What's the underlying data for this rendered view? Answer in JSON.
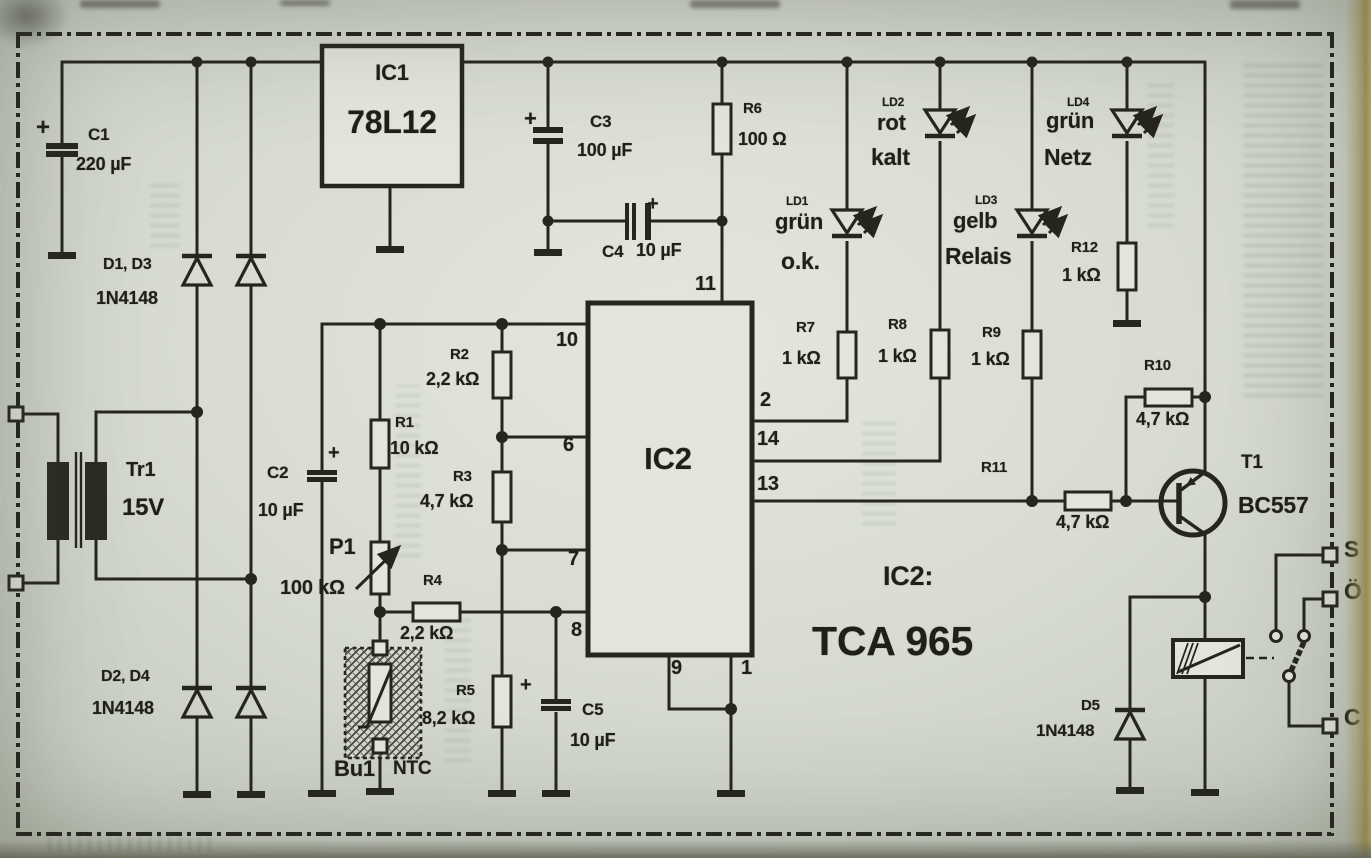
{
  "colors": {
    "paper": "#d8dbd2",
    "ink": "#26261e",
    "page_edge": "#bfae72"
  },
  "schematic": {
    "ic_note": {
      "label": "IC2:",
      "value": "TCA 965"
    },
    "components": [
      {
        "ref": "C1",
        "value": "220 µF"
      },
      {
        "ref": "C2",
        "value": "10 µF"
      },
      {
        "ref": "C3",
        "value": "100 µF"
      },
      {
        "ref": "C4",
        "value": "10 µF"
      },
      {
        "ref": "C5",
        "value": "10 µF"
      },
      {
        "ref": "R1",
        "value": "10 kΩ"
      },
      {
        "ref": "R2",
        "value": "2,2 kΩ"
      },
      {
        "ref": "R3",
        "value": "4,7 kΩ"
      },
      {
        "ref": "R4",
        "value": "2,2 kΩ"
      },
      {
        "ref": "R5",
        "value": "8,2 kΩ"
      },
      {
        "ref": "R6",
        "value": "100 Ω"
      },
      {
        "ref": "R7",
        "value": "1 kΩ"
      },
      {
        "ref": "R8",
        "value": "1 kΩ"
      },
      {
        "ref": "R9",
        "value": "1 kΩ"
      },
      {
        "ref": "R10",
        "value": "4,7 kΩ"
      },
      {
        "ref": "R11",
        "value": "4,7 kΩ"
      },
      {
        "ref": "R12",
        "value": "1 kΩ"
      },
      {
        "ref": "P1",
        "value": "100 kΩ"
      },
      {
        "ref": "D1, D3",
        "value": "1N4148"
      },
      {
        "ref": "D2, D4",
        "value": "1N4148"
      },
      {
        "ref": "D5",
        "value": "1N4148"
      },
      {
        "ref": "IC1",
        "value": "78L12"
      },
      {
        "ref": "IC2",
        "value": "TCA 965"
      },
      {
        "ref": "T1",
        "value": "BC557"
      },
      {
        "ref": "Tr1",
        "value": "15V"
      },
      {
        "ref": "Bu1",
        "value": "NTC"
      }
    ],
    "leds": [
      {
        "ref": "LD1",
        "color": "grün",
        "meaning": "o.k."
      },
      {
        "ref": "LD2",
        "color": "rot",
        "meaning": "kalt"
      },
      {
        "ref": "LD3",
        "color": "gelb",
        "meaning": "Relais"
      },
      {
        "ref": "LD4",
        "color": "grün",
        "meaning": "Netz"
      }
    ],
    "ic2_pin_numbers": [
      "11",
      "10",
      "6",
      "7",
      "8",
      "2",
      "14",
      "13",
      "9",
      "1"
    ],
    "relay_contact_labels": [
      "S",
      "Ö",
      "C"
    ]
  },
  "labels": [
    {
      "name": "c1-plus",
      "text": "+",
      "x": 36,
      "y": 116,
      "size": 24
    },
    {
      "name": "c1-ref",
      "text": "C1",
      "x": 88,
      "y": 126,
      "size": 17
    },
    {
      "name": "c1-value",
      "text": "220 µF",
      "x": 76,
      "y": 155,
      "size": 18
    },
    {
      "name": "d1d3-ref",
      "text": "D1, D3",
      "x": 103,
      "y": 257,
      "size": 16
    },
    {
      "name": "d1d3-value",
      "text": "1N4148",
      "x": 96,
      "y": 289,
      "size": 18
    },
    {
      "name": "ic1-ref",
      "text": "IC1",
      "x": 392,
      "y": 62,
      "size": 22,
      "center": true
    },
    {
      "name": "ic1-value",
      "text": "78L12",
      "x": 392,
      "y": 106,
      "size": 32,
      "center": true
    },
    {
      "name": "c3-plus",
      "text": "+",
      "x": 524,
      "y": 108,
      "size": 22
    },
    {
      "name": "c3-ref",
      "text": "C3",
      "x": 590,
      "y": 113,
      "size": 17
    },
    {
      "name": "c3-value",
      "text": "100 µF",
      "x": 577,
      "y": 141,
      "size": 18
    },
    {
      "name": "c4-plus",
      "text": "+",
      "x": 647,
      "y": 194,
      "size": 20
    },
    {
      "name": "c4-ref",
      "text": "C4",
      "x": 602,
      "y": 243,
      "size": 17
    },
    {
      "name": "c4-value",
      "text": "10 µF",
      "x": 636,
      "y": 241,
      "size": 18
    },
    {
      "name": "r6-ref",
      "text": "R6",
      "x": 743,
      "y": 101,
      "size": 15
    },
    {
      "name": "r6-value",
      "text": "100 Ω",
      "x": 738,
      "y": 130,
      "size": 18
    },
    {
      "name": "pin-11",
      "text": "11",
      "x": 695,
      "y": 274,
      "size": 20
    },
    {
      "name": "ld1-ref",
      "text": "LD1",
      "x": 786,
      "y": 195,
      "size": 12
    },
    {
      "name": "ld1-color",
      "text": "grün",
      "x": 775,
      "y": 211,
      "size": 22
    },
    {
      "name": "ld1-function",
      "text": "o.k.",
      "x": 781,
      "y": 250,
      "size": 23
    },
    {
      "name": "ld2-ref",
      "text": "LD2",
      "x": 882,
      "y": 96,
      "size": 12
    },
    {
      "name": "ld2-color",
      "text": "rot",
      "x": 877,
      "y": 112,
      "size": 22
    },
    {
      "name": "ld2-function",
      "text": "kalt",
      "x": 871,
      "y": 146,
      "size": 23
    },
    {
      "name": "ld3-ref",
      "text": "LD3",
      "x": 975,
      "y": 194,
      "size": 12
    },
    {
      "name": "ld3-color",
      "text": "gelb",
      "x": 953,
      "y": 210,
      "size": 22
    },
    {
      "name": "ld3-function",
      "text": "Relais",
      "x": 945,
      "y": 245,
      "size": 23
    },
    {
      "name": "ld4-ref",
      "text": "LD4",
      "x": 1067,
      "y": 96,
      "size": 12
    },
    {
      "name": "ld4-color",
      "text": "grün",
      "x": 1046,
      "y": 110,
      "size": 22
    },
    {
      "name": "ld4-function",
      "text": "Netz",
      "x": 1044,
      "y": 146,
      "size": 23
    },
    {
      "name": "r12-ref",
      "text": "R12",
      "x": 1071,
      "y": 240,
      "size": 15
    },
    {
      "name": "r12-value",
      "text": "1 kΩ",
      "x": 1062,
      "y": 266,
      "size": 18
    },
    {
      "name": "r7-ref",
      "text": "R7",
      "x": 796,
      "y": 320,
      "size": 15
    },
    {
      "name": "r7-value",
      "text": "1 kΩ",
      "x": 782,
      "y": 349,
      "size": 18
    },
    {
      "name": "r8-ref",
      "text": "R8",
      "x": 888,
      "y": 317,
      "size": 15
    },
    {
      "name": "r8-value",
      "text": "1 kΩ",
      "x": 878,
      "y": 347,
      "size": 18
    },
    {
      "name": "r9-ref",
      "text": "R9",
      "x": 982,
      "y": 325,
      "size": 15
    },
    {
      "name": "r9-value",
      "text": "1 kΩ",
      "x": 971,
      "y": 350,
      "size": 18
    },
    {
      "name": "r10-ref",
      "text": "R10",
      "x": 1144,
      "y": 358,
      "size": 15
    },
    {
      "name": "r10-value",
      "text": "4,7 kΩ",
      "x": 1136,
      "y": 410,
      "size": 18
    },
    {
      "name": "r11-ref",
      "text": "R11",
      "x": 981,
      "y": 460,
      "size": 15
    },
    {
      "name": "r11-value",
      "text": "4,7 kΩ",
      "x": 1056,
      "y": 513,
      "size": 18
    },
    {
      "name": "t1-ref",
      "text": "T1",
      "x": 1241,
      "y": 453,
      "size": 19
    },
    {
      "name": "t1-value",
      "text": "BC557",
      "x": 1238,
      "y": 494,
      "size": 23
    },
    {
      "name": "pin-2",
      "text": "2",
      "x": 760,
      "y": 390,
      "size": 20
    },
    {
      "name": "pin-14",
      "text": "14",
      "x": 757,
      "y": 429,
      "size": 20
    },
    {
      "name": "pin-13",
      "text": "13",
      "x": 757,
      "y": 474,
      "size": 20
    },
    {
      "name": "pin-10",
      "text": "10",
      "x": 556,
      "y": 330,
      "size": 20
    },
    {
      "name": "pin-6",
      "text": "6",
      "x": 563,
      "y": 435,
      "size": 20
    },
    {
      "name": "pin-7",
      "text": "7",
      "x": 568,
      "y": 549,
      "size": 20
    },
    {
      "name": "pin-8",
      "text": "8",
      "x": 571,
      "y": 620,
      "size": 20
    },
    {
      "name": "pin-9",
      "text": "9",
      "x": 671,
      "y": 658,
      "size": 20
    },
    {
      "name": "pin-1",
      "text": "1",
      "x": 741,
      "y": 658,
      "size": 20
    },
    {
      "name": "ic2-ref",
      "text": "IC2",
      "x": 668,
      "y": 443,
      "size": 31,
      "center": true
    },
    {
      "name": "ic2-note-label",
      "text": "IC2:",
      "x": 883,
      "y": 563,
      "size": 27
    },
    {
      "name": "ic2-note-value",
      "text": "TCA 965",
      "x": 812,
      "y": 621,
      "size": 41
    },
    {
      "name": "tr1-ref",
      "text": "Tr1",
      "x": 126,
      "y": 460,
      "size": 20
    },
    {
      "name": "tr1-value",
      "text": "15V",
      "x": 122,
      "y": 496,
      "size": 24
    },
    {
      "name": "c2-ref",
      "text": "C2",
      "x": 267,
      "y": 464,
      "size": 17
    },
    {
      "name": "c2-value",
      "text": "10 µF",
      "x": 258,
      "y": 501,
      "size": 18
    },
    {
      "name": "c2-plus",
      "text": "+",
      "x": 328,
      "y": 443,
      "size": 20
    },
    {
      "name": "r1-ref",
      "text": "R1",
      "x": 395,
      "y": 415,
      "size": 15
    },
    {
      "name": "r1-value",
      "text": "10 kΩ",
      "x": 390,
      "y": 439,
      "size": 18
    },
    {
      "name": "r2-ref",
      "text": "R2",
      "x": 450,
      "y": 347,
      "size": 15
    },
    {
      "name": "r2-value",
      "text": "2,2 kΩ",
      "x": 426,
      "y": 370,
      "size": 18
    },
    {
      "name": "r3-ref",
      "text": "R3",
      "x": 453,
      "y": 469,
      "size": 15
    },
    {
      "name": "r3-value",
      "text": "4,7 kΩ",
      "x": 420,
      "y": 492,
      "size": 18
    },
    {
      "name": "p1-ref",
      "text": "P1",
      "x": 329,
      "y": 536,
      "size": 22
    },
    {
      "name": "p1-value",
      "text": "100 kΩ",
      "x": 280,
      "y": 578,
      "size": 20
    },
    {
      "name": "r4-ref",
      "text": "R4",
      "x": 423,
      "y": 573,
      "size": 15
    },
    {
      "name": "r4-value",
      "text": "2,2 kΩ",
      "x": 400,
      "y": 624,
      "size": 18
    },
    {
      "name": "d2d4-ref",
      "text": "D2, D4",
      "x": 101,
      "y": 669,
      "size": 16
    },
    {
      "name": "d2d4-value",
      "text": "1N4148",
      "x": 92,
      "y": 699,
      "size": 18
    },
    {
      "name": "bu1-ref",
      "text": "Bu1",
      "x": 334,
      "y": 758,
      "size": 22
    },
    {
      "name": "bu1-type",
      "text": "NTC",
      "x": 393,
      "y": 759,
      "size": 19
    },
    {
      "name": "r5-ref",
      "text": "R5",
      "x": 456,
      "y": 683,
      "size": 15
    },
    {
      "name": "r5-value",
      "text": "8,2 kΩ",
      "x": 422,
      "y": 709,
      "size": 18
    },
    {
      "name": "c5-plus",
      "text": "+",
      "x": 520,
      "y": 675,
      "size": 20
    },
    {
      "name": "c5-ref",
      "text": "C5",
      "x": 582,
      "y": 701,
      "size": 17
    },
    {
      "name": "c5-value",
      "text": "10 µF",
      "x": 570,
      "y": 731,
      "size": 18
    },
    {
      "name": "d5-ref",
      "text": "D5",
      "x": 1081,
      "y": 698,
      "size": 15
    },
    {
      "name": "d5-value",
      "text": "1N4148",
      "x": 1036,
      "y": 722,
      "size": 17
    },
    {
      "name": "terminal-s",
      "text": "S",
      "x": 1344,
      "y": 538,
      "size": 23
    },
    {
      "name": "terminal-oe",
      "text": "Ö",
      "x": 1344,
      "y": 580,
      "size": 23
    },
    {
      "name": "terminal-c",
      "text": "C",
      "x": 1344,
      "y": 706,
      "size": 23
    }
  ]
}
